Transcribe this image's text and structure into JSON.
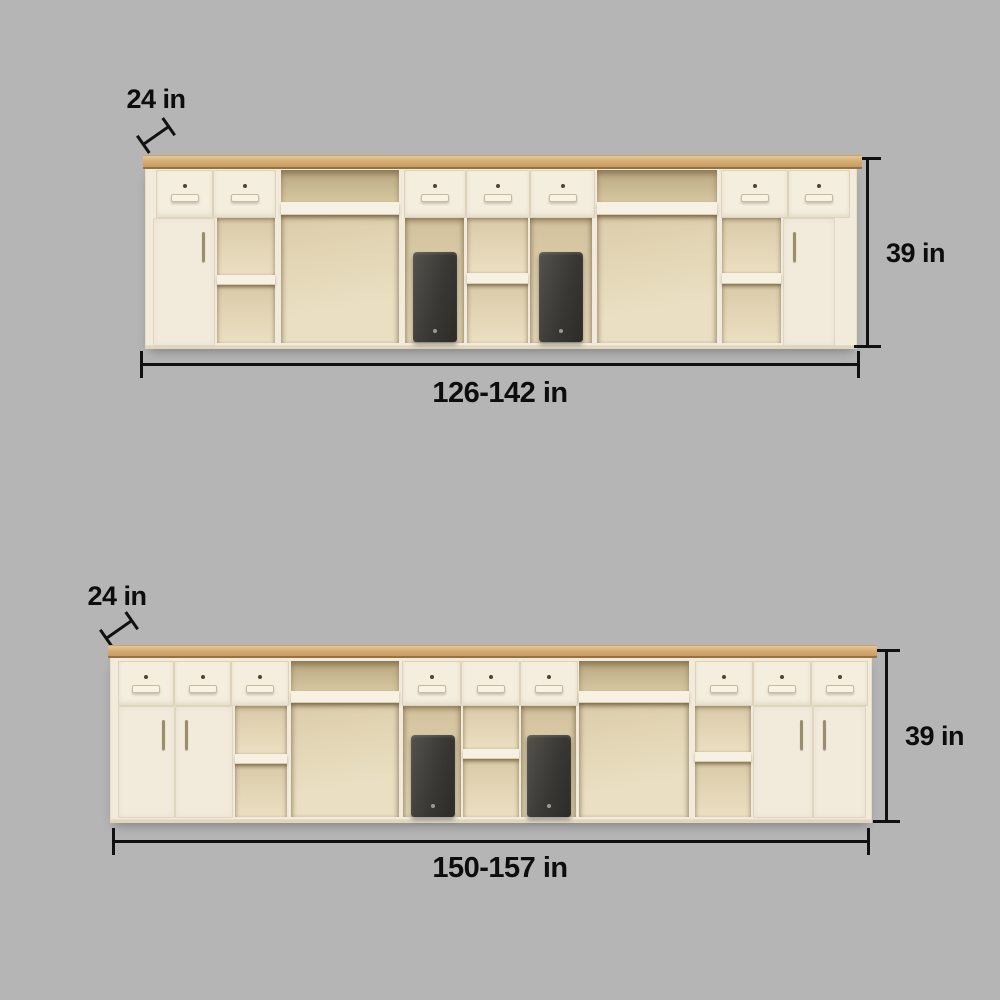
{
  "page": {
    "background_color": "#b5b5b5",
    "description": "Product dimension diagram of two reception counter cabinet units"
  },
  "colors": {
    "background": "#b5b5b5",
    "cabinet_body": "#f2ebdc",
    "wood_countertop": "#d3a96f",
    "compartment_interior": "#dccdaa",
    "pc_tower": "#3a3834",
    "dimension_ink": "#111111"
  },
  "top_diagram": {
    "depth_label": "24 in",
    "height_label": "39 in",
    "width_label": "126-142 in"
  },
  "bottom_diagram": {
    "depth_label": "24 in",
    "height_label": "39 in",
    "width_label": "150-157 in"
  }
}
